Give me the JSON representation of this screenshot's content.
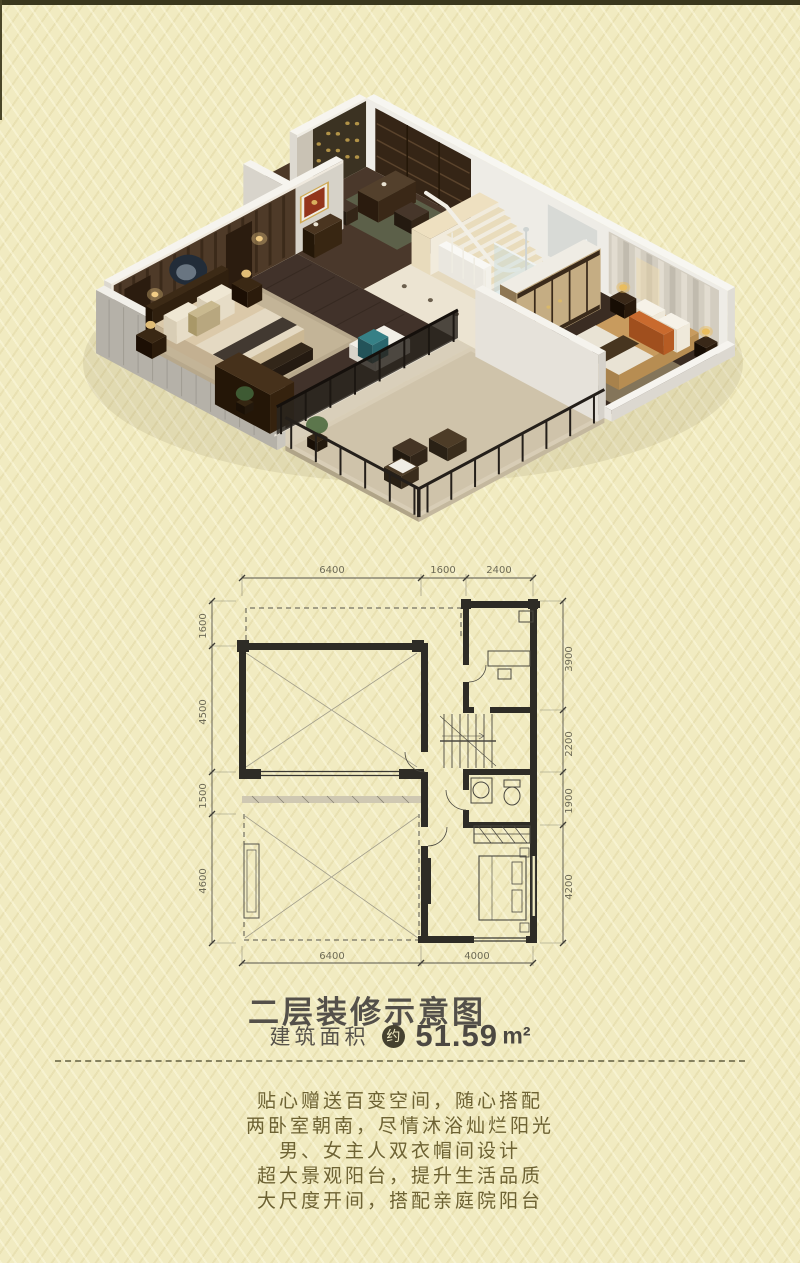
{
  "title": "二层装修示意图",
  "area": {
    "label": "建筑面积",
    "badge": "约",
    "value": "51.59",
    "unit": "m²"
  },
  "description": {
    "line1": "贴心赠送百变空间，随心搭配",
    "line2": "两卧室朝南，尽情沐浴灿烂阳光",
    "line3": "男、女主人双衣帽间设计",
    "line4": "超大景观阳台，提升生活品质",
    "line5": "大尺度开间，搭配亲庭院阳台"
  },
  "floor_plan": {
    "dimensions": {
      "top": [
        "6400",
        "1600",
        "2400"
      ],
      "left": [
        "1600",
        "4500",
        "1500",
        "4600"
      ],
      "right": [
        "3900",
        "2200",
        "1900",
        "4200"
      ],
      "bottom": [
        "6400",
        "4000"
      ]
    }
  },
  "colors": {
    "background": "#f1ebc1",
    "top_border": "#3a371d",
    "title_text": "#54504a",
    "paragraph_text": "#6d6233",
    "badge_background": "#45412f",
    "plan_walls": "#2e2c26",
    "dimension_text": "#6d6a56"
  }
}
